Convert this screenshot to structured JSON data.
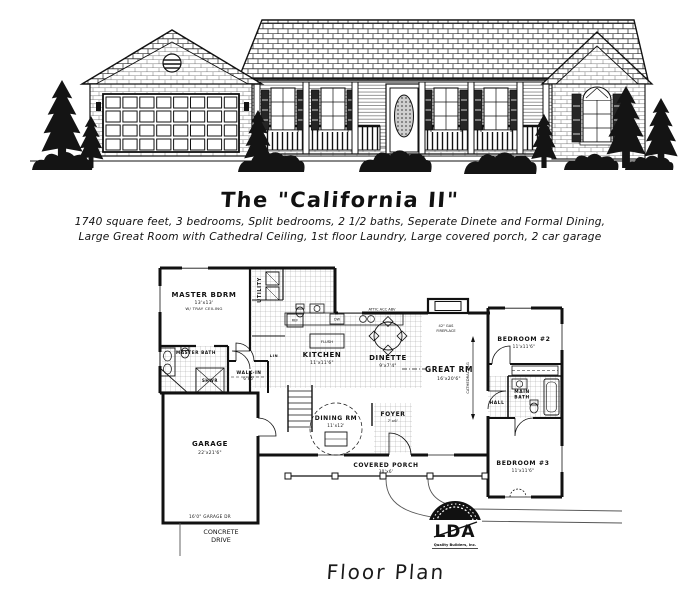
{
  "header": {
    "title": "The \"California II\"",
    "line1": "1740 square feet, 3 bedrooms, Split bedrooms, 2 1/2 baths, Seperate Dinete and Formal Dining,",
    "line2": "Large Great Room with Cathedral Ceiling, 1st floor Laundry, Large covered porch, 2 car garage"
  },
  "caption": "Floor Plan",
  "colors": {
    "ink": "#1a1a1a",
    "paper": "#ffffff",
    "foliage": "#141414"
  },
  "plan": {
    "master_bdrm": "MASTER BDRM",
    "master_bdrm_dims": "13'x13'",
    "master_bdrm_note": "W/ TRAY CEILING",
    "master_bath": "MASTER BATH",
    "shwr": "SHWR",
    "walk_in": "WALK-IN",
    "walk_in_dims": "6'x5'",
    "lin": "LIN",
    "utility": "UTILITY",
    "kitchen": "KITCHEN",
    "kitchen_dims": "11'x11'6\"",
    "ref": "REF",
    "dw": "DW",
    "island": "FLUSH",
    "attic_note": "ATTIC ACC ABV",
    "dinette": "DINETTE",
    "dinette_dims": "9'x7'4\"",
    "great_rm": "GREAT RM",
    "great_rm_dims": "16'x20'6\"",
    "fireplace_note1": "42\" GAS",
    "fireplace_note2": "FIREPLACE",
    "cathedral": "CATHEDRAL CLG",
    "dining_rm": "DINING RM",
    "dining_rm_dims": "11'x12'",
    "foyer": "FOYER",
    "foyer_dims": "7'x6'",
    "covered_porch": "COVERED PORCH",
    "covered_porch_dims": "30'x6'",
    "garage": "GARAGE",
    "garage_dims": "22'x21'6\"",
    "garage_door": "16'0\" GARAGE DR",
    "bedroom2": "BEDROOM #2",
    "bedroom2_dims": "11'x11'6\"",
    "bedroom3": "BEDROOM #3",
    "bedroom3_dims": "11'x11'6\"",
    "main_bath1": "MAIN",
    "main_bath2": "BATH",
    "hall": "HALL",
    "drive1": "CONCRETE",
    "drive2": "DRIVE"
  },
  "logo": {
    "text": "LDA",
    "subtext": "Quality Builders, Inc."
  }
}
